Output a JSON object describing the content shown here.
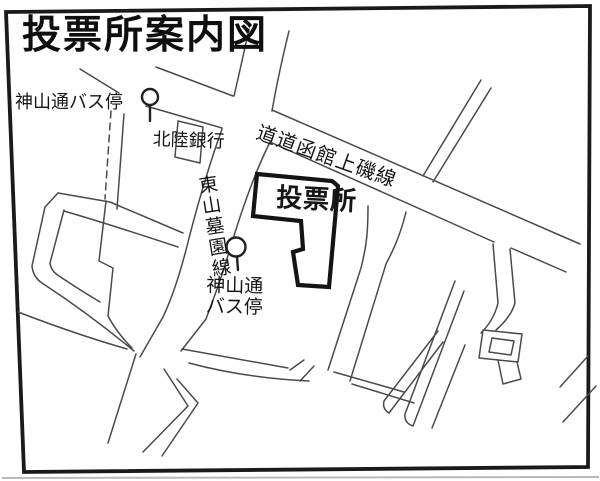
{
  "title": "投票所案内図",
  "map": {
    "labels": {
      "bus_stop_1": "神山通バス停",
      "bank": "北陸銀行",
      "road_main": "道道函館上磯線",
      "road_vertical": "東山墓園線",
      "polling_place": "投票所",
      "bus_stop_2": "神山通\nバス停"
    },
    "icons": {
      "bus_stop": "pole-with-circle"
    },
    "colors": {
      "ink": "#141414",
      "road_line": "#4a4a4a",
      "background": "#ffffff"
    }
  }
}
